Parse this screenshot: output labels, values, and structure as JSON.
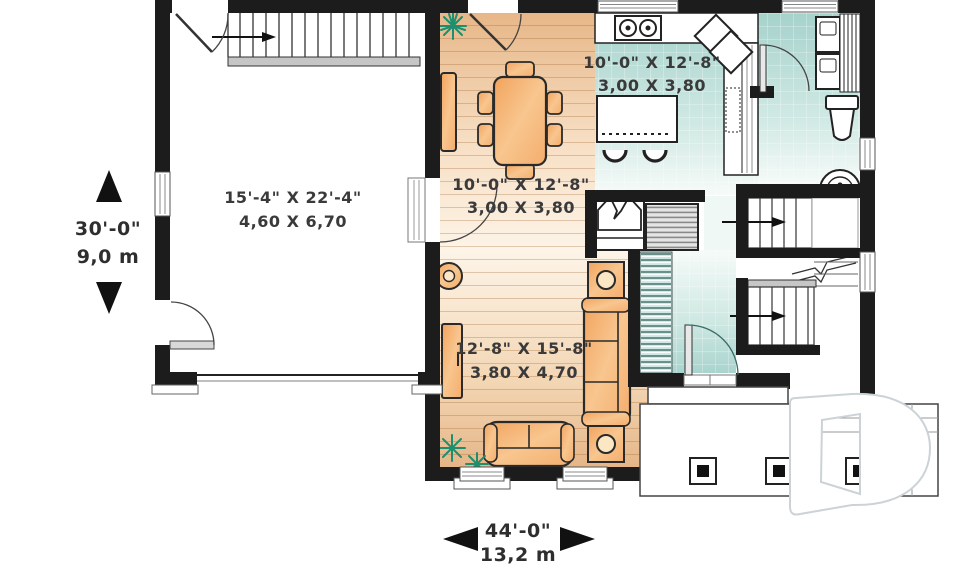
{
  "plan": {
    "rooms": {
      "garage": {
        "imperial": "15'-4\" X 22'-4\"",
        "metric": "4,60 X 6,70"
      },
      "dining": {
        "imperial": "10'-0\" X 12'-8\"",
        "metric": "3,00 X 3,80"
      },
      "kitchen": {
        "imperial": "10'-0\" X 12'-8\"",
        "metric": "3,00 X 3,80"
      },
      "living": {
        "imperial": "12'-8\" X 15'-8\"",
        "metric": "3,80 X 4,70"
      }
    },
    "overall_dimensions": {
      "depth": {
        "imperial": "30'-0\"",
        "metric": "9,0 m"
      },
      "width": {
        "imperial": "44'-0\"",
        "metric": "13,2 m"
      }
    },
    "watermark": {
      "letter": "D"
    },
    "colors": {
      "wall": "#1c1c1c",
      "wood_floor": "#eec092",
      "tile_floor": "#aed6d0",
      "furniture": "#f5b06c",
      "plant": "#23a07f",
      "label_text": "#3a3a3a"
    }
  }
}
